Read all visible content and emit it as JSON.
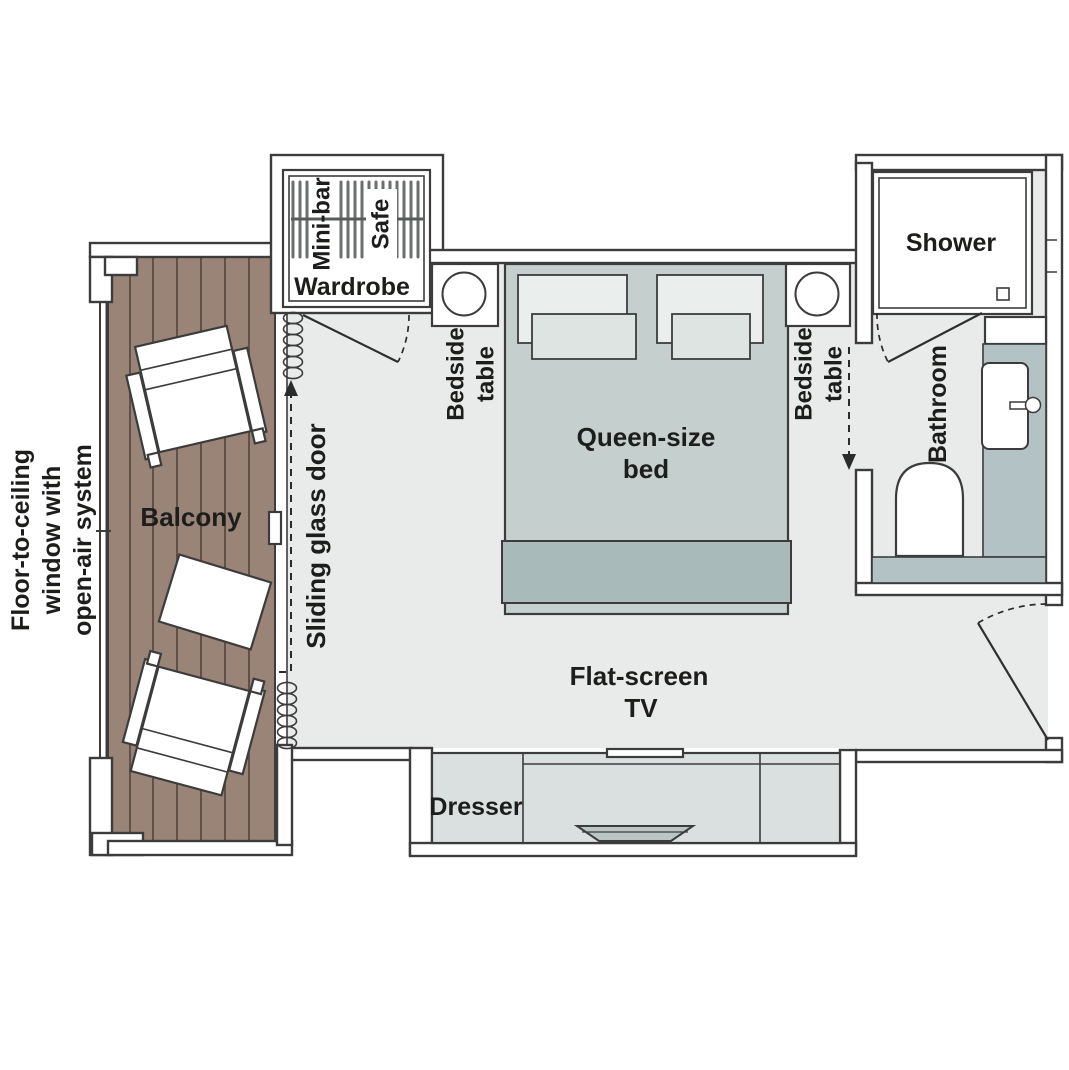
{
  "labels": {
    "balcony": "Balcony",
    "window_line1": "Floor-to-ceiling",
    "window_line2": "window with",
    "window_line3": "open-air system",
    "sliding_door": "Sliding glass door",
    "wardrobe": "Wardrobe",
    "minibar": "Mini-bar",
    "safe": "Safe",
    "bedside_line1": "Bedside",
    "bedside_line2": "table",
    "bed_line1": "Queen-size",
    "bed_line2": "bed",
    "tv_line1": "Flat-screen",
    "tv_line2": "TV",
    "dresser": "Dresser",
    "shower": "Shower",
    "bathroom": "Bathroom"
  },
  "colors": {
    "wood": "#9a8478",
    "plank_line": "#574840",
    "floor": "#e9ebea",
    "bed": "#c5d0ce",
    "bed_footer": "#a8bbba",
    "pillow_outer": "#eaeeec",
    "pillow_inner": "#dde4e2",
    "furniture": "#dae0df",
    "counter": "#b3c2c4",
    "tv": "#b9c6c5",
    "wall_line": "#3c3c3c",
    "text": "#1d1d1b"
  }
}
